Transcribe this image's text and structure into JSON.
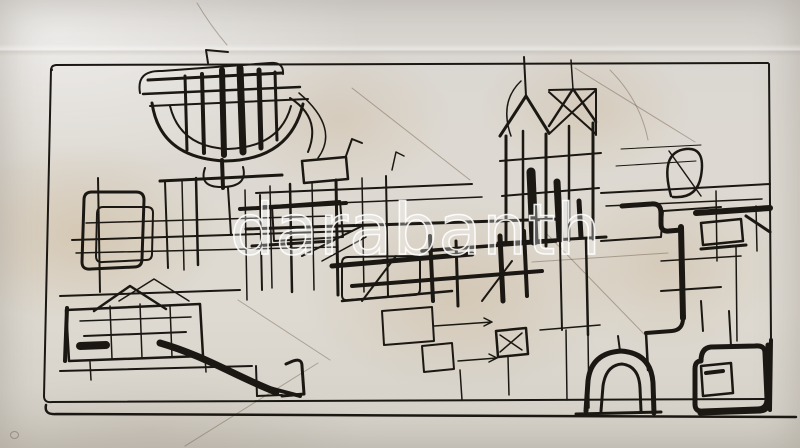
{
  "watermark": {
    "text": "darabanth"
  },
  "artwork": {
    "description": "Abstract continuous-line black ink drawing of an architectural cityscape with towers, houses, an arch and a sweeping curve, inside a hand-drawn rectangular frame on stained cream paper",
    "medium": "ink on paper"
  },
  "palette": {
    "paper": "#dcd8d0",
    "paper_highlight": "#ebe8e2",
    "stain": "#c1a06f",
    "ink": "#1b1813",
    "faint": "rgba(95,76,54,0.40)",
    "watermark_stroke": "#ffffff"
  },
  "strokes": [
    {
      "d": "M575,68 L695,142",
      "w": 1,
      "f": 1
    },
    {
      "d": "M532,262 L668,253",
      "w": 1,
      "f": 1
    },
    {
      "d": "M545,232 L645,335",
      "w": 1,
      "f": 1
    },
    {
      "d": "M318,363 L185,446",
      "w": 1,
      "f": 1
    },
    {
      "d": "M352,88 L470,180",
      "w": 1,
      "f": 1
    },
    {
      "d": "M238,300 L330,360",
      "w": 1,
      "f": 1
    },
    {
      "d": "M197,3 Q210,25 227,45",
      "w": 1,
      "f": 1
    },
    {
      "d": "M610,70 Q640,100 648,140",
      "w": 1,
      "f": 1
    },
    {
      "d": "M52,70 Q50,66 56,65 L768,63",
      "w": 2
    },
    {
      "d": "M769,64 L771,340",
      "w": 2
    },
    {
      "d": "M771,340 L770,410",
      "w": 4
    },
    {
      "d": "M51,69 L44,396",
      "w": 2
    },
    {
      "d": "M44,396 Q44,403 52,402 L764,399",
      "w": 2
    },
    {
      "d": "M46,405 Q44,415 56,414 L796,417",
      "w": 2.5
    },
    {
      "d": "M700,413 L760,411 Q770,410 769,400 L768,345",
      "w": 5
    },
    {
      "d": "M140,93 Q136,70 162,71 L270,63 Q284,62 283,74",
      "w": 2
    },
    {
      "d": "M148,80 L282,73",
      "w": 3
    },
    {
      "d": "M143,94 L300,87",
      "w": 2.5
    },
    {
      "d": "M150,106 L308,99",
      "w": 2
    },
    {
      "d": "M152,103 Q160,158 225,161 Q290,160 303,104",
      "w": 3
    },
    {
      "d": "M170,106 Q180,147 228,149 Q280,147 291,106",
      "w": 2
    },
    {
      "d": "M185,76 L187,150",
      "w": 3
    },
    {
      "d": "M202,74 L204,153",
      "w": 4
    },
    {
      "d": "M222,70 L224,155",
      "w": 6
    },
    {
      "d": "M240,68 L243,152",
      "w": 7
    },
    {
      "d": "M259,70 L261,148",
      "w": 5
    },
    {
      "d": "M275,72 L277,140",
      "w": 3
    },
    {
      "d": "M290,98 Q322,118 308,152",
      "w": 2
    },
    {
      "d": "M299,93 Q340,128 318,158",
      "w": 1.5
    },
    {
      "d": "M222,160 L223,188",
      "w": 4
    },
    {
      "d": "M205,168 Q198,188 224,187 Q248,186 243,167",
      "w": 2
    },
    {
      "d": "M228,188 L231,235",
      "w": 2
    },
    {
      "d": "M208,63 L206,50 L228,52",
      "w": 2
    },
    {
      "d": "M245,190 L247,300",
      "w": 1.5
    },
    {
      "d": "M260,195 L262,290",
      "w": 2
    },
    {
      "d": "M92,192 Q84,192 84,200 L82,262 Q82,270 91,269 L134,267 Q142,267 142,259 L144,200 Q144,192 136,192 Z",
      "w": 3
    },
    {
      "d": "M103,207 Q97,207 97,214 L96,256 Q96,263 103,262 L146,260 Q152,260 152,254 L153,213 Q153,207 147,207 Z",
      "w": 2
    },
    {
      "d": "M72,240 L352,231",
      "w": 2
    },
    {
      "d": "M76,253 L338,247",
      "w": 1.5
    },
    {
      "d": "M86,223 L330,216",
      "w": 1.5
    },
    {
      "d": "M240,209 L346,203",
      "w": 4
    },
    {
      "d": "M252,246 L332,241",
      "w": 3
    },
    {
      "d": "M272,206 L340,201 L343,237 L274,241 Z",
      "w": 2
    },
    {
      "d": "M302,256 L362,226",
      "w": 2
    },
    {
      "d": "M322,261 L366,237",
      "w": 1.5
    },
    {
      "d": "M165,182 L168,268",
      "w": 2
    },
    {
      "d": "M182,180 L184,270",
      "w": 1.5
    },
    {
      "d": "M196,178 L198,265",
      "w": 2.5
    },
    {
      "d": "M160,181 L282,175",
      "w": 3
    },
    {
      "d": "M60,296 L240,290",
      "w": 2
    },
    {
      "d": "M98,178 L100,292",
      "w": 2
    },
    {
      "d": "M94,311 L130,286 L166,309",
      "w": 2.5
    },
    {
      "d": "M119,301 L154,279 L189,301",
      "w": 1.5
    },
    {
      "d": "M66,310 L200,304 L203,356 L69,361 Z",
      "w": 2.5
    },
    {
      "d": "M80,321 L191,317",
      "w": 1.5
    },
    {
      "d": "M84,336 L186,332",
      "w": 2
    },
    {
      "d": "M67,308 L65,361",
      "w": 4
    },
    {
      "d": "M80,346 L106,345",
      "w": 8
    },
    {
      "d": "M110,306 L112,359",
      "w": 1.5
    },
    {
      "d": "M140,304 L142,358",
      "w": 1.5
    },
    {
      "d": "M170,306 L172,357",
      "w": 1.5
    },
    {
      "d": "M160,343 C205,356 235,376 276,392",
      "w": 7
    },
    {
      "d": "M262,386 L300,396",
      "w": 4
    },
    {
      "d": "M282,396 L304,394 L302,366 Q302,358 293,361 L286,364",
      "w": 3
    },
    {
      "d": "M60,371 L252,366",
      "w": 2
    },
    {
      "d": "M256,366 L257,396",
      "w": 2
    },
    {
      "d": "M257,396 L282,395",
      "w": 2
    },
    {
      "d": "M90,362 L91,380",
      "w": 1.5
    },
    {
      "d": "M205,357 L206,372",
      "w": 1.5
    },
    {
      "d": "M302,161 L346,157 L348,179 L304,183 Z",
      "w": 2.5
    },
    {
      "d": "M346,156 L352,139 L362,143",
      "w": 2
    },
    {
      "d": "M392,170 L396,152 L404,156",
      "w": 1.5
    },
    {
      "d": "M256,193 L472,184",
      "w": 2
    },
    {
      "d": "M262,206 L482,197",
      "w": 1.5
    },
    {
      "d": "M246,229 L560,219",
      "w": 3
    },
    {
      "d": "M270,186 L272,288",
      "w": 1.5
    },
    {
      "d": "M290,184 L292,292",
      "w": 2.5
    },
    {
      "d": "M312,182 L314,290",
      "w": 1.5
    },
    {
      "d": "M336,180 L338,295",
      "w": 3
    },
    {
      "d": "M362,178 L364,292",
      "w": 1.5
    },
    {
      "d": "M386,176 L388,296",
      "w": 2
    },
    {
      "d": "M332,266 L472,254",
      "w": 5
    },
    {
      "d": "M352,286 L542,271",
      "w": 4
    },
    {
      "d": "M422,251 L556,241",
      "w": 3.5
    },
    {
      "d": "M342,301 L452,291",
      "w": 2.5
    },
    {
      "d": "M430,236 L433,301",
      "w": 4
    },
    {
      "d": "M456,241 L458,306",
      "w": 3
    },
    {
      "d": "M500,236 L503,301",
      "w": 5
    },
    {
      "d": "M524,231 L527,296",
      "w": 4
    },
    {
      "d": "M362,301 L396,256",
      "w": 2
    },
    {
      "d": "M482,301 L512,261",
      "w": 2
    },
    {
      "d": "M348,257 Q342,257 342,263 L342,295 Q342,301 348,300 L414,295 Q420,295 420,289 L420,261 Q420,255 414,256 Z",
      "w": 2
    },
    {
      "d": "M382,311 L432,307 L434,341 L384,345 Z",
      "w": 2
    },
    {
      "d": "M434,326 L492,322 M484,318 L492,322 L484,326",
      "w": 1.5
    },
    {
      "d": "M422,346 L452,343 L454,369 L424,372 Z",
      "w": 2
    },
    {
      "d": "M496,331 L526,328 L528,354 L498,357 Z",
      "w": 2.5
    },
    {
      "d": "M500,335 L522,350 M522,333 L500,352",
      "w": 1.5
    },
    {
      "d": "M458,361 L497,358 M489,354 L497,358 L489,362",
      "w": 1.5
    },
    {
      "d": "M508,357 L509,395",
      "w": 1.5
    },
    {
      "d": "M460,370 L462,400",
      "w": 1.5
    },
    {
      "d": "M500,136 L526,96 L549,133",
      "w": 3
    },
    {
      "d": "M526,96 L524,57",
      "w": 2
    },
    {
      "d": "M549,126 L573,89 L596,122",
      "w": 2.5
    },
    {
      "d": "M573,89 L571,60",
      "w": 1.5
    },
    {
      "d": "M549,90 L596,89 L596,135 M549,92 L596,134 M596,90 L549,134",
      "w": 2
    },
    {
      "d": "M506,136 L506,241",
      "w": 3
    },
    {
      "d": "M523,131 L523,243",
      "w": 2.5
    },
    {
      "d": "M546,134 L546,246",
      "w": 3
    },
    {
      "d": "M569,126 L569,241",
      "w": 2.5
    },
    {
      "d": "M593,123 L593,239",
      "w": 3
    },
    {
      "d": "M500,161 L601,153",
      "w": 2
    },
    {
      "d": "M502,196 L599,188",
      "w": 2
    },
    {
      "d": "M531,172 L534,241",
      "w": 9
    },
    {
      "d": "M557,182 L560,239",
      "w": 7
    },
    {
      "d": "M579,201 L581,237",
      "w": 5
    },
    {
      "d": "M511,136 Q499,102 521,81",
      "w": 1.5
    },
    {
      "d": "M498,243 L606,237",
      "w": 3
    },
    {
      "d": "M560,243 L562,330",
      "w": 2
    },
    {
      "d": "M586,240 L588,335",
      "w": 2.5
    },
    {
      "d": "M588,335 L589,408",
      "w": 1.5
    },
    {
      "d": "M566,330 L567,400",
      "w": 1.5
    },
    {
      "d": "M540,330 L600,325",
      "w": 1.5
    },
    {
      "d": "M601,193 L770,184",
      "w": 2
    },
    {
      "d": "M606,206 L762,199",
      "w": 1.5
    },
    {
      "d": "M601,241 L661,237 L663,211 L721,207",
      "w": 2
    },
    {
      "d": "M671,196 Q659,152 686,149 Q706,147 701,176 Q697,199 673,197",
      "w": 2.5
    },
    {
      "d": "M669,151 L701,196",
      "w": 1.5
    },
    {
      "d": "M621,149 L701,145",
      "w": 1
    },
    {
      "d": "M616,166 L696,161",
      "w": 1
    },
    {
      "d": "M622,206 L651,204 Q661,203 661,213 L661,224 Q661,232 669,231 L681,230",
      "w": 5
    },
    {
      "d": "M696,213 L770,208",
      "w": 6
    },
    {
      "d": "M681,227 L683,318",
      "w": 6
    },
    {
      "d": "M701,223 L741,219 L743,241 L703,245 Z",
      "w": 2.5
    },
    {
      "d": "M746,216 L770,232",
      "w": 3
    },
    {
      "d": "M701,249 L746,245",
      "w": 3
    },
    {
      "d": "M661,261 L741,256",
      "w": 1.5
    },
    {
      "d": "M716,191 L717,261",
      "w": 1.5
    },
    {
      "d": "M756,206 L757,251",
      "w": 1.5
    },
    {
      "d": "M661,291 L721,287",
      "w": 2
    },
    {
      "d": "M701,301 L703,331",
      "w": 2
    },
    {
      "d": "M736,246 L737,341",
      "w": 1.5
    },
    {
      "d": "M683,318 Q683,330 672,331 L646,333",
      "w": 4
    },
    {
      "d": "M646,333 L648,370",
      "w": 2.5
    },
    {
      "d": "M701,361 Q695,361 695,369 L695,404 Q695,412 703,411 L757,409 Q767,409 767,399 L765,353 Q765,345 755,346 L711,347 Q701,348 701,361 Z",
      "w": 5
    },
    {
      "d": "M701,366 L731,363 L733,393 L703,396 Z",
      "w": 2.5
    },
    {
      "d": "M706,373 L723,371",
      "w": 4
    },
    {
      "d": "M731,346 L729,311",
      "w": 2
    },
    {
      "d": "M586,411 L588,381 Q591,353 621,351 Q651,353 653,383 L654,413",
      "w": 5
    },
    {
      "d": "M601,411 L603,386 Q606,365 622,364 Q639,366 640,388 L641,411",
      "w": 3
    },
    {
      "d": "M576,414 L661,412",
      "w": 3
    },
    {
      "d": "M620,351 L618,336",
      "w": 2
    }
  ]
}
